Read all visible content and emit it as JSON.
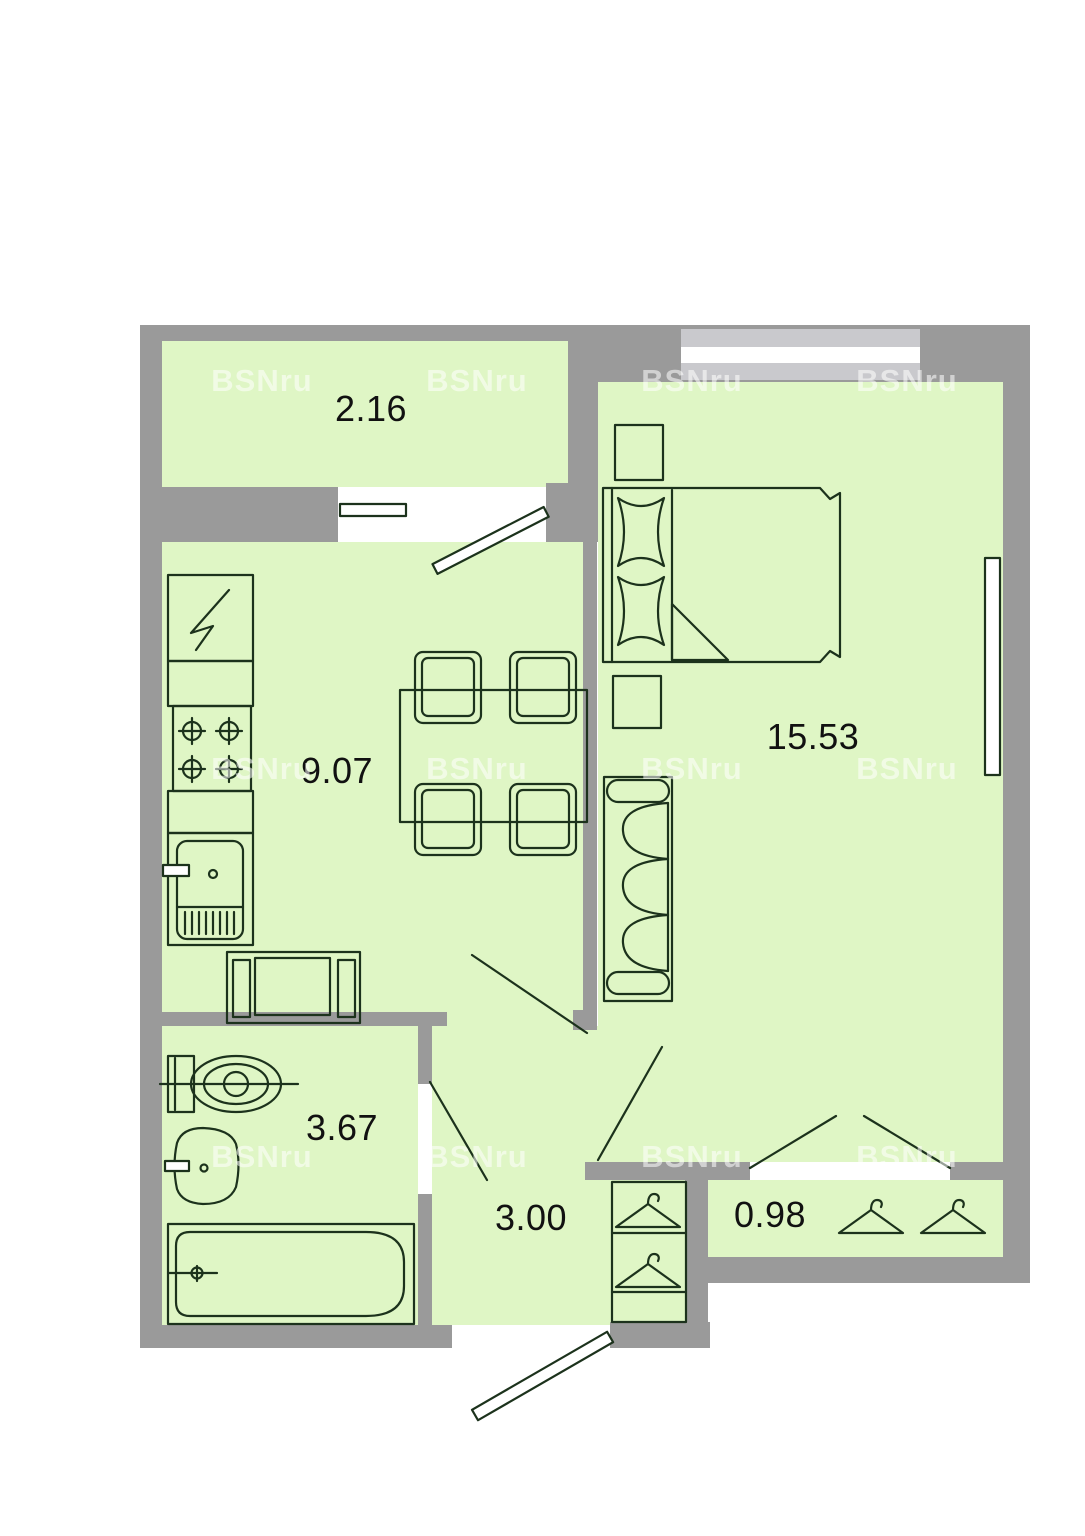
{
  "plan": {
    "name": "apartment-floor-plan",
    "watermark": "BSNru",
    "colors": {
      "wall": "#9a9a9a",
      "room_fill": "#dff6c5",
      "outline": "#1c321c",
      "window_band": "#c9c9cd",
      "background": "#ffffff"
    },
    "rooms": [
      {
        "id": "balcony",
        "label": "2.16"
      },
      {
        "id": "kitchen-dining",
        "label": "9.07"
      },
      {
        "id": "bedroom-living",
        "label": "15.53"
      },
      {
        "id": "bathroom",
        "label": "3.67"
      },
      {
        "id": "hallway",
        "label": "3.00"
      },
      {
        "id": "closet",
        "label": "0.98"
      }
    ]
  }
}
